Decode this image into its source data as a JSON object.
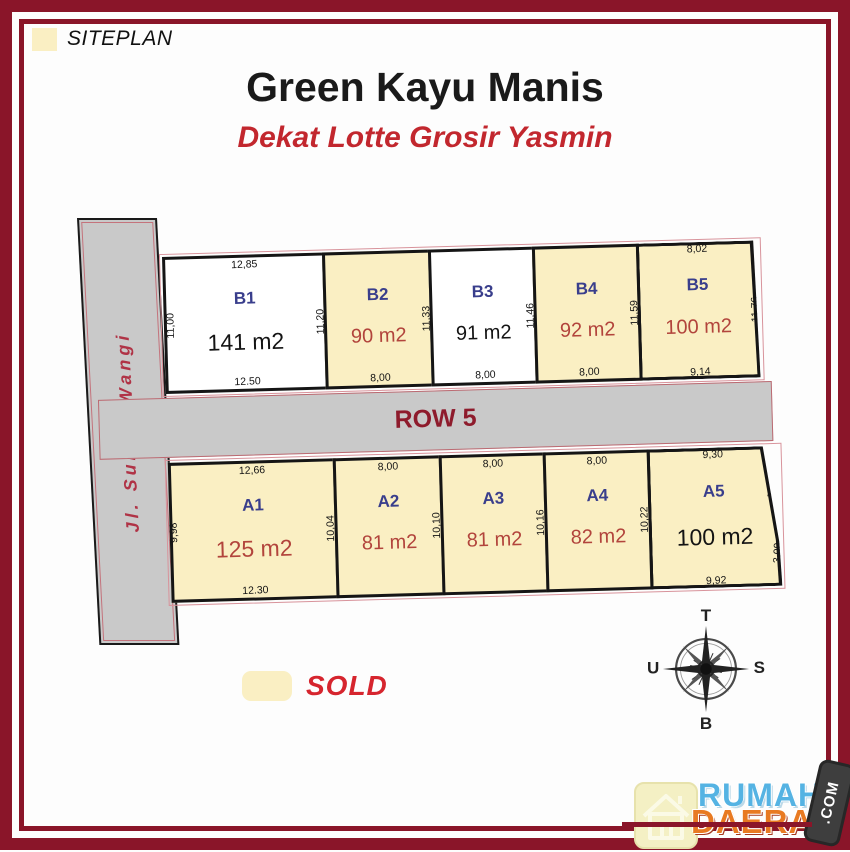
{
  "header": {
    "siteplan_label": "SITEPLAN",
    "title": "Green Kayu Manis",
    "subtitle": "Dekat Lotte Grosir Yasmin"
  },
  "siteplan": {
    "street_label": "Jl. Sumur Wangi",
    "row_label": "ROW 5",
    "lots_top": [
      {
        "id": "B1",
        "area": "141 m2",
        "status": "available",
        "dim_top": "12,85",
        "dim_left": "11,00",
        "dim_right": "11,20",
        "dim_bottom": "12.50"
      },
      {
        "id": "B2",
        "area": "90 m2",
        "status": "sold",
        "dim_right": "11,33",
        "dim_bottom": "8,00"
      },
      {
        "id": "B3",
        "area": "91 m2",
        "status": "available",
        "dim_right": "11,46",
        "dim_bottom": "8,00"
      },
      {
        "id": "B4",
        "area": "92 m2",
        "status": "sold",
        "dim_right": "11,59",
        "dim_bottom": "8,00"
      },
      {
        "id": "B5",
        "area": "100 m2",
        "status": "sold",
        "dim_top": "8,02",
        "dim_right": "11,76",
        "dim_bottom": "9,14"
      }
    ],
    "lots_bottom": [
      {
        "id": "A1",
        "area": "125 m2",
        "status": "sold",
        "dim_top": "12,66",
        "dim_left": "9,98",
        "dim_right": "10,04",
        "dim_bottom": "12.30"
      },
      {
        "id": "A2",
        "area": "81 m2",
        "status": "sold",
        "dim_top": "8,00",
        "dim_right": "10,10"
      },
      {
        "id": "A3",
        "area": "81 m2",
        "status": "sold",
        "dim_top": "8,00",
        "dim_right": "10,16"
      },
      {
        "id": "A4",
        "area": "82 m2",
        "status": "sold",
        "dim_top": "8,00",
        "dim_right": "10,22"
      },
      {
        "id": "A5",
        "area": "100 m2",
        "status": "sold",
        "dim_top": "9,30",
        "dim_right_upper": "7,24",
        "dim_right_lower": "3,09",
        "dim_bottom": "9,92"
      }
    ]
  },
  "legend": {
    "label": "SOLD"
  },
  "compass": {
    "top": "T",
    "bottom": "B",
    "left": "U",
    "right": "S"
  },
  "logo": {
    "word1": "RUMAH",
    "word2": "DAERAH",
    "badge": ".COM"
  },
  "colors": {
    "frame": "#8a1529",
    "sold_fill": "#faefc3",
    "road_fill": "#c9c9c9",
    "lot_label": "#393e8c",
    "area_red": "#b2443c",
    "accent_red": "#c2272e",
    "row_text": "#8e1b2c",
    "sold_text": "#d6252e",
    "logo_blue": "#55b3e3",
    "logo_orange": "#e87a22"
  }
}
